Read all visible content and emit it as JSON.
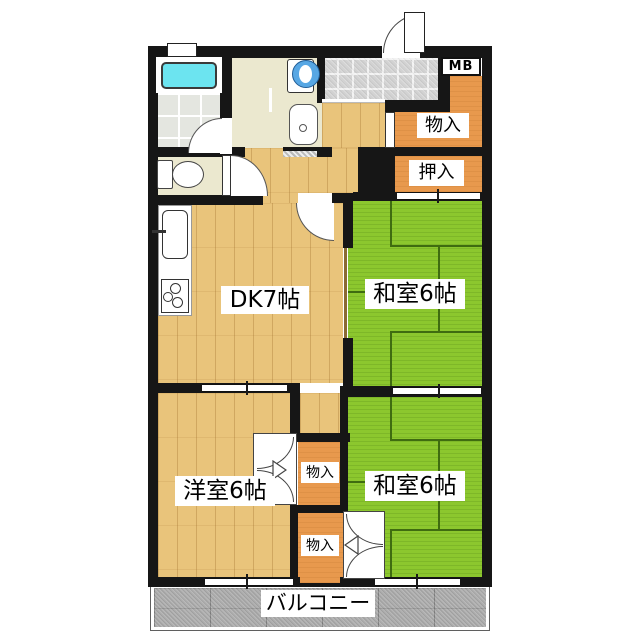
{
  "floorplan": {
    "rooms": {
      "dining_kitchen": {
        "label": "DK7帖"
      },
      "japanese_room_upper": {
        "label": "和室6帖"
      },
      "japanese_room_lower": {
        "label": "和室6帖"
      },
      "western_room": {
        "label": "洋室6帖"
      },
      "balcony": {
        "label": "バルコニー"
      }
    },
    "storage": {
      "entrance_storage": {
        "label": "物入"
      },
      "oshiire_closet": {
        "label": "押入"
      },
      "middle_storage": {
        "label": "物入"
      },
      "lower_storage": {
        "label": "物入"
      }
    },
    "meter_box": {
      "label": "MB"
    },
    "colors": {
      "wall": "#161616",
      "tatami_green": "#8cc72e",
      "tatami_line": "#3f6c10",
      "wood_floor": "#e9c47b",
      "storage_orange": "#e8994d",
      "entrance_tile": "#d2d2d2",
      "bath_tile": "#e4e6e0",
      "utility_floor": "#ebe8cf",
      "balcony_gray": "#adadad",
      "bathtub_cyan": "#6ce4f0",
      "washer_blue": "#57a7e4"
    }
  }
}
